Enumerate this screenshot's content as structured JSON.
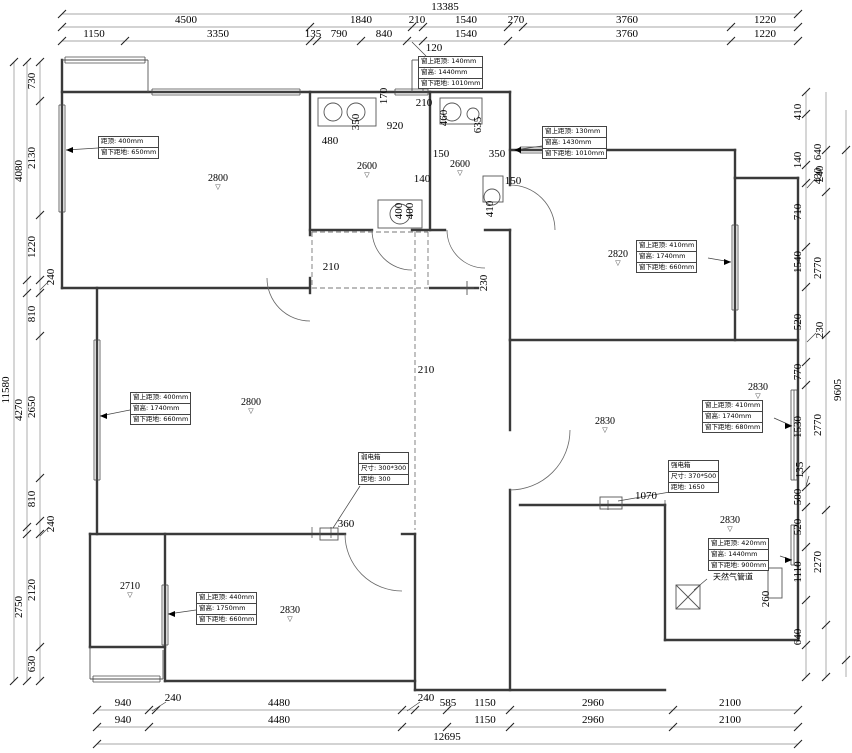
{
  "colors": {
    "background": "#ffffff",
    "wall": "#3a3a3a",
    "dim_text": "#000000",
    "chain_line": "#8a8a8a"
  },
  "plan": {
    "walls": [
      [
        62,
        60,
        62,
        288
      ],
      [
        62,
        92,
        510,
        92
      ],
      [
        510,
        92,
        510,
        185
      ],
      [
        510,
        230,
        510,
        340
      ],
      [
        430,
        92,
        430,
        230
      ],
      [
        310,
        92,
        310,
        235
      ],
      [
        310,
        278,
        310,
        293
      ],
      [
        310,
        230,
        372,
        230
      ],
      [
        412,
        230,
        445,
        230
      ],
      [
        485,
        230,
        510,
        230
      ],
      [
        510,
        150,
        735,
        150
      ],
      [
        735,
        150,
        735,
        178
      ],
      [
        735,
        178,
        798,
        178
      ],
      [
        798,
        178,
        798,
        640
      ],
      [
        735,
        178,
        735,
        340
      ],
      [
        510,
        340,
        798,
        340
      ],
      [
        62,
        288,
        310,
        288
      ],
      [
        97,
        288,
        97,
        534
      ],
      [
        90,
        534,
        345,
        534
      ],
      [
        402,
        534,
        415,
        534
      ],
      [
        90,
        534,
        90,
        647
      ],
      [
        90,
        647,
        165,
        647
      ],
      [
        165,
        534,
        165,
        681
      ],
      [
        165,
        681,
        415,
        681
      ],
      [
        415,
        534,
        415,
        690
      ],
      [
        510,
        340,
        510,
        430
      ],
      [
        510,
        490,
        510,
        690
      ],
      [
        415,
        690,
        665,
        690
      ],
      [
        520,
        505,
        665,
        505
      ],
      [
        665,
        505,
        665,
        640
      ],
      [
        665,
        640,
        798,
        640
      ],
      [
        430,
        288,
        478,
        288
      ]
    ],
    "thin": [
      [
        62,
        60,
        148,
        60
      ],
      [
        148,
        60,
        148,
        92
      ],
      [
        90,
        647,
        90,
        679
      ],
      [
        90,
        679,
        163,
        679
      ],
      [
        163,
        650,
        163,
        679
      ],
      [
        412,
        60,
        412,
        92
      ],
      [
        423,
        60,
        423,
        92
      ],
      [
        412,
        60,
        423,
        60
      ],
      [
        460,
        288,
        474,
        288
      ],
      [
        467,
        281,
        467,
        295
      ]
    ],
    "windows": [
      {
        "o": "h",
        "c": 92,
        "a": 152,
        "b": 300
      },
      {
        "o": "h",
        "c": 92,
        "a": 395,
        "b": 428
      },
      {
        "o": "h",
        "c": 150,
        "a": 520,
        "b": 600
      },
      {
        "o": "v",
        "c": 62,
        "a": 105,
        "b": 212
      },
      {
        "o": "v",
        "c": 97,
        "a": 340,
        "b": 480
      },
      {
        "o": "v",
        "c": 735,
        "a": 225,
        "b": 310
      },
      {
        "o": "v",
        "c": 794,
        "a": 390,
        "b": 480
      },
      {
        "o": "v",
        "c": 794,
        "a": 525,
        "b": 565
      },
      {
        "o": "v",
        "c": 165,
        "a": 585,
        "b": 645
      },
      {
        "o": "h",
        "c": 679,
        "a": 93,
        "b": 160
      },
      {
        "o": "h",
        "c": 60,
        "a": 65,
        "b": 145
      }
    ],
    "dashed": [
      [
        312,
        232,
        428,
        232
      ],
      [
        312,
        232,
        312,
        288
      ],
      [
        428,
        232,
        428,
        288
      ],
      [
        312,
        288,
        428,
        288
      ],
      [
        415,
        232,
        415,
        530
      ]
    ],
    "arcs": [
      {
        "cx": 310,
        "cy": 278,
        "r": 43,
        "a1": 90,
        "a2": 180,
        "sw": 1
      },
      {
        "cx": 412,
        "cy": 230,
        "r": 40,
        "a1": 180,
        "a2": 90,
        "sw": 0
      },
      {
        "cx": 485,
        "cy": 230,
        "r": 38,
        "a1": 180,
        "a2": 90,
        "sw": 0
      },
      {
        "cx": 510,
        "cy": 230,
        "r": 45,
        "a1": 270,
        "a2": 360,
        "sw": 1
      },
      {
        "cx": 402,
        "cy": 534,
        "r": 57,
        "a1": 180,
        "a2": 90,
        "sw": 0
      },
      {
        "cx": 510,
        "cy": 430,
        "r": 60,
        "a1": 0,
        "a2": 90,
        "sw": 1
      }
    ],
    "circles": [
      [
        333,
        112,
        9
      ],
      [
        356,
        112,
        9
      ],
      [
        452,
        112,
        9
      ],
      [
        400,
        214,
        10
      ],
      [
        492,
        197,
        8
      ],
      [
        473,
        114,
        6
      ]
    ],
    "rects": [
      [
        318,
        98,
        58,
        28,
        ""
      ],
      [
        378,
        200,
        44,
        28,
        ""
      ],
      [
        440,
        98,
        42,
        26,
        ""
      ],
      [
        483,
        176,
        20,
        26,
        ""
      ],
      [
        600,
        497,
        22,
        12,
        ""
      ],
      [
        320,
        528,
        18,
        12,
        ""
      ],
      [
        676,
        585,
        24,
        24,
        "x"
      ],
      [
        768,
        568,
        14,
        30,
        ""
      ]
    ],
    "extra_lines": [
      [
        360,
        486,
        333,
        528
      ],
      [
        670,
        492,
        618,
        501
      ],
      [
        694,
        590,
        707,
        579
      ],
      [
        608,
        500,
        608,
        510
      ],
      [
        665,
        500,
        665,
        510
      ],
      [
        312,
        527,
        312,
        538
      ],
      [
        331,
        527,
        331,
        538
      ]
    ]
  },
  "chains": [
    {
      "axis": "h",
      "pos": 14,
      "from": 62,
      "to": 798,
      "ticks": [
        62,
        798
      ],
      "labels": [
        {
          "t": "13385",
          "at": 445
        }
      ]
    },
    {
      "axis": "h",
      "pos": 27,
      "from": 62,
      "to": 798,
      "ticks": [
        62,
        310,
        412,
        423,
        508,
        523,
        731,
        798
      ],
      "labels": [
        {
          "t": "4500",
          "at": 186
        },
        {
          "t": "1840",
          "at": 361
        },
        {
          "t": "210",
          "at": 417
        },
        {
          "t": "1540",
          "at": 466
        },
        {
          "t": "270",
          "at": 516
        },
        {
          "t": "3760",
          "at": 627
        },
        {
          "t": "1220",
          "at": 765
        }
      ]
    },
    {
      "axis": "h",
      "pos": 41,
      "from": 62,
      "to": 798,
      "ticks": [
        62,
        125,
        310,
        317,
        361,
        407,
        423,
        508,
        731,
        798
      ],
      "labels": [
        {
          "t": "1150",
          "at": 94
        },
        {
          "t": "3350",
          "at": 218
        },
        {
          "t": "135",
          "at": 313
        },
        {
          "t": "790",
          "at": 339
        },
        {
          "t": "840",
          "at": 384
        },
        {
          "t": "1540",
          "at": 466
        },
        {
          "t": "3760",
          "at": 627
        },
        {
          "t": "1220",
          "at": 765
        }
      ]
    },
    {
      "axis": "v",
      "pos": 14,
      "from": 62,
      "to": 681,
      "ticks": [
        62,
        681
      ],
      "labels": [
        {
          "t": "11580",
          "at": 390
        }
      ]
    },
    {
      "axis": "v",
      "pos": 27,
      "from": 62,
      "to": 681,
      "ticks": [
        62,
        280,
        293,
        527,
        534,
        681
      ],
      "labels": [
        {
          "t": "4080",
          "at": 171
        },
        {
          "t": "4270",
          "at": 410
        },
        {
          "t": "2750",
          "at": 607
        }
      ]
    },
    {
      "axis": "v",
      "pos": 40,
      "from": 62,
      "to": 681,
      "ticks": [
        62,
        101,
        215,
        280,
        293,
        336,
        478,
        521,
        534,
        647,
        681
      ],
      "labels": [
        {
          "t": "730",
          "at": 81
        },
        {
          "t": "2130",
          "at": 158
        },
        {
          "t": "1220",
          "at": 247
        },
        {
          "t": "810",
          "at": 314
        },
        {
          "t": "2650",
          "at": 407
        },
        {
          "t": "810",
          "at": 499
        },
        {
          "t": "2120",
          "at": 590
        },
        {
          "t": "630",
          "at": 664
        }
      ]
    },
    {
      "axis": "v",
      "pos": 806,
      "from": 92,
      "to": 677,
      "ticks": [
        92,
        114,
        165,
        183,
        247,
        287,
        362,
        385,
        470,
        487,
        507,
        547,
        600,
        645,
        677
      ],
      "labels": [
        {
          "t": "410",
          "at": 112
        },
        {
          "t": "140",
          "at": 160
        },
        {
          "t": "710",
          "at": 212
        },
        {
          "t": "1540",
          "at": 262
        },
        {
          "t": "520",
          "at": 322
        },
        {
          "t": "770",
          "at": 372
        },
        {
          "t": "1530",
          "at": 427
        },
        {
          "t": "500",
          "at": 497
        },
        {
          "t": "520",
          "at": 527
        },
        {
          "t": "1110",
          "at": 572
        },
        {
          "t": "640",
          "at": 637
        }
      ]
    },
    {
      "axis": "v",
      "pos": 826,
      "from": 92,
      "to": 677,
      "ticks": [
        150,
        192,
        335,
        510,
        625,
        677
      ],
      "labels": [
        {
          "t": "640",
          "at": 152
        },
        {
          "t": "430",
          "at": 176
        },
        {
          "t": "2770",
          "at": 268
        },
        {
          "t": "2770",
          "at": 425
        },
        {
          "t": "2270",
          "at": 562
        }
      ]
    },
    {
      "axis": "v",
      "pos": 846,
      "from": 110,
      "to": 677,
      "ticks": [
        150,
        660
      ],
      "labels": [
        {
          "t": "9605",
          "at": 390
        }
      ]
    },
    {
      "axis": "h",
      "pos": 710,
      "from": 97,
      "to": 798,
      "ticks": [
        97,
        149,
        156,
        402,
        415,
        447,
        510,
        673,
        798
      ],
      "labels": [
        {
          "t": "940",
          "at": 123
        },
        {
          "t": "4480",
          "at": 279
        },
        {
          "t": "585",
          "at": 448
        },
        {
          "t": "1150",
          "at": 485
        },
        {
          "t": "2960",
          "at": 593
        },
        {
          "t": "2100",
          "at": 730
        }
      ]
    },
    {
      "axis": "h",
      "pos": 727,
      "from": 97,
      "to": 798,
      "ticks": [
        97,
        149,
        402,
        447,
        510,
        673,
        798
      ],
      "labels": [
        {
          "t": "940",
          "at": 123
        },
        {
          "t": "4480",
          "at": 279
        },
        {
          "t": "1150",
          "at": 485
        },
        {
          "t": "2960",
          "at": 593
        },
        {
          "t": "2100",
          "at": 730
        }
      ]
    },
    {
      "axis": "h",
      "pos": 744,
      "from": 97,
      "to": 798,
      "ticks": [
        97,
        798
      ],
      "labels": [
        {
          "t": "12695",
          "at": 447
        }
      ]
    }
  ],
  "leaders": [
    {
      "t": "240",
      "x": 51,
      "y": 277,
      "rot": 1,
      "line": [
        40,
        290,
        49,
        281
      ]
    },
    {
      "t": "240",
      "x": 51,
      "y": 524,
      "rot": 1,
      "line": [
        40,
        536,
        49,
        527
      ]
    },
    {
      "t": "240",
      "x": 820,
      "y": 174,
      "rot": 1,
      "line": [
        807,
        188,
        816,
        178
      ]
    },
    {
      "t": "230",
      "x": 820,
      "y": 330,
      "rot": 1,
      "line": [
        807,
        342,
        816,
        333
      ]
    },
    {
      "t": "135",
      "x": 800,
      "y": 470,
      "rot": 1,
      "line": [
        806,
        486,
        809,
        476
      ]
    },
    {
      "t": "120",
      "x": 434,
      "y": 48,
      "rot": 0,
      "line": [
        412,
        42,
        426,
        56
      ]
    },
    {
      "t": "240",
      "x": 173,
      "y": 698,
      "rot": 0,
      "line": [
        152,
        711,
        166,
        702
      ]
    },
    {
      "t": "240",
      "x": 426,
      "y": 698,
      "rot": 0,
      "line": [
        407,
        711,
        420,
        702
      ]
    }
  ],
  "texts": [
    {
      "t": "480",
      "x": 330,
      "y": 141
    },
    {
      "t": "920",
      "x": 395,
      "y": 126
    },
    {
      "t": "350",
      "x": 356,
      "y": 122,
      "rot": 1
    },
    {
      "t": "170",
      "x": 384,
      "y": 96,
      "rot": 1
    },
    {
      "t": "210",
      "x": 424,
      "y": 103
    },
    {
      "t": "460",
      "x": 444,
      "y": 118,
      "rot": 1
    },
    {
      "t": "150",
      "x": 441,
      "y": 154
    },
    {
      "t": "140",
      "x": 422,
      "y": 179
    },
    {
      "t": "400",
      "x": 399,
      "y": 211,
      "rot": 1
    },
    {
      "t": "400",
      "x": 410,
      "y": 211,
      "rot": 1
    },
    {
      "t": "635",
      "x": 478,
      "y": 125,
      "rot": 1
    },
    {
      "t": "350",
      "x": 497,
      "y": 154
    },
    {
      "t": "410",
      "x": 490,
      "y": 209,
      "rot": 1
    },
    {
      "t": "150",
      "x": 513,
      "y": 181
    },
    {
      "t": "210",
      "x": 331,
      "y": 267
    },
    {
      "t": "230",
      "x": 484,
      "y": 283,
      "rot": 1
    },
    {
      "t": "210",
      "x": 426,
      "y": 370
    },
    {
      "t": "360",
      "x": 346,
      "y": 524
    },
    {
      "t": "1070",
      "x": 646,
      "y": 496
    },
    {
      "t": "260",
      "x": 766,
      "y": 599,
      "rot": 1
    },
    {
      "t": "天然气管道",
      "x": 733,
      "y": 577,
      "cls": "cn"
    }
  ],
  "rooms": [
    {
      "t": "2800",
      "x": 218,
      "y": 182
    },
    {
      "t": "2600",
      "x": 367,
      "y": 170
    },
    {
      "t": "2600",
      "x": 460,
      "y": 168
    },
    {
      "t": "2820",
      "x": 618,
      "y": 258
    },
    {
      "t": "2800",
      "x": 251,
      "y": 406
    },
    {
      "t": "2830",
      "x": 605,
      "y": 425
    },
    {
      "t": "2830",
      "x": 758,
      "y": 391
    },
    {
      "t": "2710",
      "x": 130,
      "y": 590
    },
    {
      "t": "2830",
      "x": 290,
      "y": 614
    },
    {
      "t": "2830",
      "x": 730,
      "y": 524
    }
  ],
  "room_marker": "▽",
  "callouts": [
    {
      "x": 98,
      "y": 136,
      "lines": [
        "距顶: 400mm",
        "窗下距地: 650mm"
      ],
      "leader": [
        98,
        148,
        66,
        150
      ],
      "arrow": "l"
    },
    {
      "x": 418,
      "y": 56,
      "lines": [
        "窗上距顶: 140mm",
        "窗高: 1440mm",
        "窗下距地: 1010mm"
      ]
    },
    {
      "x": 542,
      "y": 126,
      "lines": [
        "窗上距顶: 130mm",
        "窗高: 1430mm",
        "窗下距地: 1010mm"
      ],
      "leader": [
        542,
        146,
        514,
        150
      ],
      "arrow": "l"
    },
    {
      "x": 636,
      "y": 240,
      "lines": [
        "窗上距顶: 410mm",
        "窗高: 1740mm",
        "窗下距地: 660mm"
      ],
      "leader": [
        708,
        258,
        731,
        262
      ],
      "arrow": "r"
    },
    {
      "x": 130,
      "y": 392,
      "lines": [
        "窗上距顶: 400mm",
        "窗高: 1740mm",
        "窗下距地: 660mm"
      ],
      "leader": [
        130,
        410,
        100,
        416
      ],
      "arrow": "l"
    },
    {
      "x": 702,
      "y": 400,
      "lines": [
        "窗上距顶: 410mm",
        "窗高: 1740mm",
        "窗下距地: 680mm"
      ],
      "leader": [
        774,
        418,
        792,
        426
      ],
      "arrow": "r"
    },
    {
      "x": 358,
      "y": 452,
      "lines": [
        "弱电箱",
        "尺寸: 300*300",
        "距地: 300"
      ]
    },
    {
      "x": 668,
      "y": 460,
      "lines": [
        "强电箱",
        "尺寸: 370*500",
        "距地: 1650"
      ]
    },
    {
      "x": 708,
      "y": 538,
      "lines": [
        "窗上距顶: 420mm",
        "窗高: 1440mm",
        "窗下距地: 900mm"
      ],
      "leader": [
        780,
        556,
        792,
        560
      ],
      "arrow": "r"
    },
    {
      "x": 196,
      "y": 592,
      "lines": [
        "窗上距顶: 440mm",
        "窗高: 1750mm",
        "窗下距地: 660mm"
      ],
      "leader": [
        196,
        610,
        168,
        614
      ],
      "arrow": "l"
    }
  ]
}
